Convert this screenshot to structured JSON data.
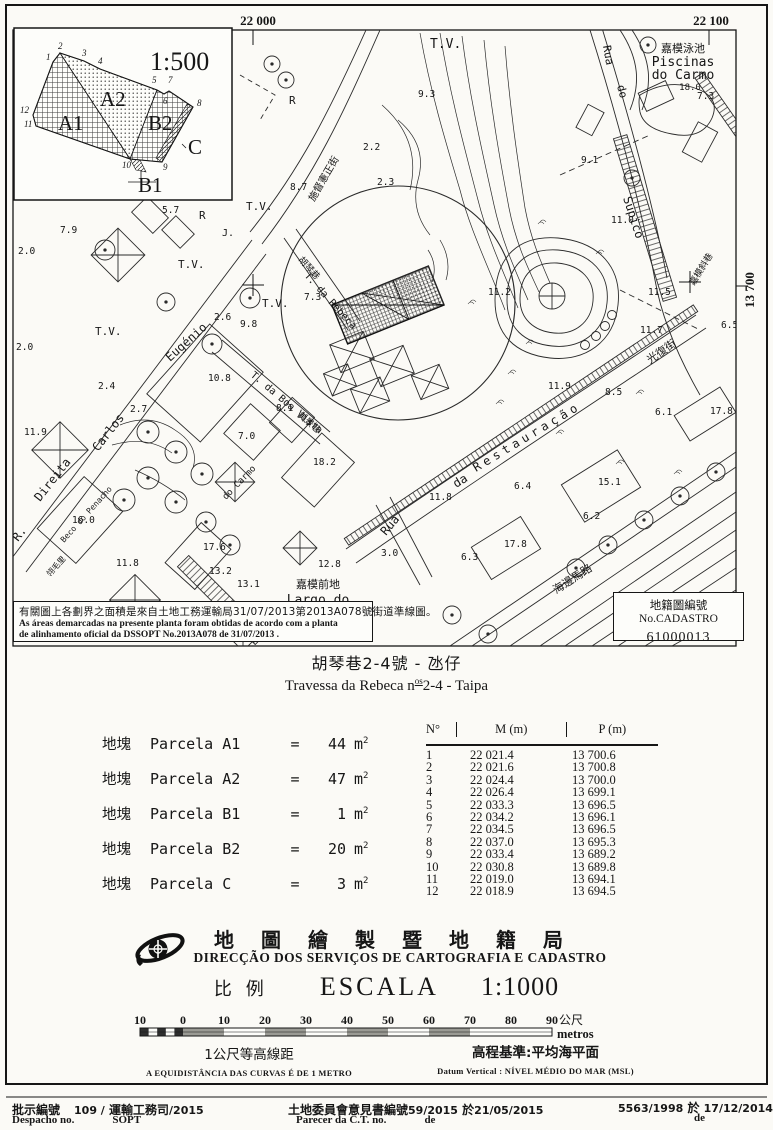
{
  "grid": {
    "top_left": "22 000",
    "top_right": "22 100",
    "right": "13 700"
  },
  "inset": {
    "labels": [
      {
        "t": "1:500",
        "x": 150,
        "y": 70,
        "s": 26,
        "cls": "ser",
        "n": "inset-scale"
      },
      {
        "t": "A1",
        "x": 58,
        "y": 130,
        "s": 21,
        "cls": "ser",
        "n": "parcel-label-a1"
      },
      {
        "t": "A2",
        "x": 100,
        "y": 106,
        "s": 21,
        "cls": "ser",
        "n": "parcel-label-a2"
      },
      {
        "t": "B2",
        "x": 148,
        "y": 130,
        "s": 21,
        "cls": "ser",
        "n": "parcel-label-b2"
      },
      {
        "t": "B1",
        "x": 138,
        "y": 192,
        "s": 21,
        "cls": "ser",
        "n": "parcel-label-b1"
      },
      {
        "t": "C",
        "x": 188,
        "y": 154,
        "s": 21,
        "cls": "ser",
        "n": "parcel-label-c"
      },
      {
        "t": "1",
        "x": 46,
        "y": 60,
        "cls": "vtx"
      },
      {
        "t": "2",
        "x": 58,
        "y": 49,
        "cls": "vtx"
      },
      {
        "t": "3",
        "x": 82,
        "y": 56,
        "cls": "vtx"
      },
      {
        "t": "4",
        "x": 98,
        "y": 64,
        "cls": "vtx"
      },
      {
        "t": "5",
        "x": 152,
        "y": 83,
        "cls": "vtx"
      },
      {
        "t": "7",
        "x": 168,
        "y": 83,
        "cls": "vtx"
      },
      {
        "t": "6",
        "x": 163,
        "y": 104,
        "cls": "vtx"
      },
      {
        "t": "8",
        "x": 197,
        "y": 106,
        "cls": "vtx"
      },
      {
        "t": "12",
        "x": 20,
        "y": 113,
        "cls": "vtx"
      },
      {
        "t": "11",
        "x": 24,
        "y": 127,
        "cls": "vtx"
      },
      {
        "t": "10",
        "x": 122,
        "y": 168,
        "cls": "vtx"
      },
      {
        "t": "9",
        "x": 163,
        "y": 170,
        "cls": "vtx"
      }
    ]
  },
  "map": {
    "labels": [
      {
        "t": "T.V.",
        "x": 430,
        "y": 48,
        "s": 13,
        "cls": "mono"
      },
      {
        "t": "T.V.",
        "x": 246,
        "y": 210,
        "s": 11,
        "cls": "mono"
      },
      {
        "t": "T.V.",
        "x": 178,
        "y": 268,
        "s": 11,
        "cls": "mono"
      },
      {
        "t": "T.V.",
        "x": 262,
        "y": 307,
        "s": 11,
        "cls": "mono"
      },
      {
        "t": "T.V.",
        "x": 95,
        "y": 335,
        "s": 11,
        "cls": "mono"
      },
      {
        "t": "R",
        "x": 289,
        "y": 104,
        "s": 11,
        "cls": "mono"
      },
      {
        "t": "R",
        "x": 199,
        "y": 219,
        "s": 11,
        "cls": "mono"
      },
      {
        "t": "J.",
        "x": 222,
        "y": 236,
        "s": 10,
        "cls": "mono"
      },
      {
        "t": "嘉模泳池",
        "x": 683,
        "y": 52,
        "s": 11,
        "cls": "cjk",
        "anchor": "middle"
      },
      {
        "t": "Piscinas",
        "x": 683,
        "y": 66,
        "s": 13,
        "cls": "mono",
        "anchor": "middle"
      },
      {
        "t": "do Carmo",
        "x": 683,
        "y": 79,
        "s": 13,
        "cls": "mono",
        "anchor": "middle"
      },
      {
        "t": "18.0",
        "x": 690,
        "y": 90,
        "s": 9,
        "cls": "mono",
        "anchor": "middle"
      },
      {
        "t": "Rua",
        "x": 603,
        "y": 46,
        "s": 11,
        "cls": "mono",
        "rot": 80
      },
      {
        "t": "do",
        "x": 617,
        "y": 86,
        "s": 11,
        "cls": "mono",
        "rot": 75
      },
      {
        "t": "Supico",
        "x": 623,
        "y": 198,
        "s": 12,
        "cls": "mono",
        "rot": 72
      },
      {
        "t": "施督憲正街",
        "x": 314,
        "y": 202,
        "s": 10,
        "cls": "cjk",
        "rot": -60
      },
      {
        "t": "胡琴巷",
        "x": 298,
        "y": 260,
        "s": 9,
        "cls": "cjk",
        "rot": 48
      },
      {
        "t": "T. da Rebeca",
        "x": 304,
        "y": 276,
        "s": 10,
        "cls": "mono",
        "rot": 48
      },
      {
        "t": "T. da Boa Vista",
        "x": 250,
        "y": 376,
        "s": 10,
        "cls": "mono",
        "rot": 40
      },
      {
        "t": "美景巷",
        "x": 297,
        "y": 416,
        "s": 9,
        "cls": "cjk",
        "rot": 40
      },
      {
        "t": "Eugénio",
        "x": 170,
        "y": 362,
        "s": 12,
        "cls": "mono",
        "rot": -42
      },
      {
        "t": "Carlos",
        "x": 98,
        "y": 452,
        "s": 12,
        "cls": "mono",
        "rot": -52
      },
      {
        "t": "Direita",
        "x": 40,
        "y": 502,
        "s": 12,
        "cls": "mono",
        "rot": -52
      },
      {
        "t": "R.",
        "x": 18,
        "y": 542,
        "s": 12,
        "cls": "mono",
        "rot": -52
      },
      {
        "t": "Beco do Penacho",
        "x": 64,
        "y": 543,
        "s": 8,
        "cls": "mono",
        "rot": -48
      },
      {
        "t": "翎毛里",
        "x": 50,
        "y": 577,
        "s": 8,
        "cls": "cjk",
        "rot": -48
      },
      {
        "t": "do Carmo",
        "x": 226,
        "y": 500,
        "s": 9,
        "cls": "mono",
        "rot": -46
      },
      {
        "t": "嘉模前地",
        "x": 318,
        "y": 588,
        "s": 11,
        "cls": "cjk",
        "anchor": "middle"
      },
      {
        "t": "Largo do",
        "x": 318,
        "y": 604,
        "s": 13,
        "cls": "mono",
        "anchor": "middle"
      },
      {
        "t": "Carmo",
        "x": 318,
        "y": 619,
        "s": 13,
        "cls": "mono",
        "anchor": "middle"
      },
      {
        "t": "Rua",
        "x": 386,
        "y": 536,
        "s": 12,
        "cls": "mono",
        "rot": -50
      },
      {
        "t": "da",
        "x": 456,
        "y": 488,
        "s": 12,
        "cls": "mono",
        "rot": -31
      },
      {
        "t": "Restauração",
        "x": 476,
        "y": 472,
        "s": 12,
        "cls": "mono",
        "rot": -31,
        "ls": 4
      },
      {
        "t": "光復街",
        "x": 650,
        "y": 364,
        "s": 11,
        "cls": "cjk",
        "rot": -35
      },
      {
        "t": "海邊馬路",
        "x": 556,
        "y": 594,
        "s": 11,
        "cls": "cjk",
        "rot": -33
      },
      {
        "t": "嘉模斜巷",
        "x": 694,
        "y": 286,
        "s": 9,
        "cls": "cjk",
        "rot": -58
      }
    ],
    "spots": [
      {
        "t": "9.3",
        "x": 418,
        "y": 97
      },
      {
        "t": "7.3",
        "x": 697,
        "y": 99
      },
      {
        "t": "7.9",
        "x": 60,
        "y": 233
      },
      {
        "t": "5.7",
        "x": 162,
        "y": 213
      },
      {
        "t": "2.2",
        "x": 363,
        "y": 150
      },
      {
        "t": "2.3",
        "x": 377,
        "y": 185
      },
      {
        "t": "8.7",
        "x": 290,
        "y": 190
      },
      {
        "t": "7.3",
        "x": 304,
        "y": 300
      },
      {
        "t": "9.8",
        "x": 240,
        "y": 327
      },
      {
        "t": "2.0",
        "x": 18,
        "y": 254
      },
      {
        "t": "2.0",
        "x": 16,
        "y": 350
      },
      {
        "t": "2.4",
        "x": 98,
        "y": 389
      },
      {
        "t": "2.6",
        "x": 214,
        "y": 320
      },
      {
        "t": "10.8",
        "x": 208,
        "y": 381
      },
      {
        "t": "2.7",
        "x": 130,
        "y": 412
      },
      {
        "t": "11.9",
        "x": 24,
        "y": 435
      },
      {
        "t": "16.0",
        "x": 72,
        "y": 523
      },
      {
        "t": "7.0",
        "x": 238,
        "y": 439
      },
      {
        "t": "8.1",
        "x": 276,
        "y": 411
      },
      {
        "t": "18.2",
        "x": 313,
        "y": 465
      },
      {
        "t": "17.6",
        "x": 203,
        "y": 550
      },
      {
        "t": "13.2",
        "x": 209,
        "y": 574
      },
      {
        "t": "13.1",
        "x": 237,
        "y": 587
      },
      {
        "t": "11.8",
        "x": 116,
        "y": 566
      },
      {
        "t": "12.8",
        "x": 318,
        "y": 567
      },
      {
        "t": "3.0",
        "x": 381,
        "y": 556
      },
      {
        "t": "9.1",
        "x": 581,
        "y": 163
      },
      {
        "t": "11.0",
        "x": 611,
        "y": 223
      },
      {
        "t": "11.5",
        "x": 648,
        "y": 295
      },
      {
        "t": "11.7",
        "x": 640,
        "y": 333
      },
      {
        "t": "6.5",
        "x": 721,
        "y": 328
      },
      {
        "t": "11.9",
        "x": 548,
        "y": 389
      },
      {
        "t": "8.5",
        "x": 605,
        "y": 395
      },
      {
        "t": "11.2",
        "x": 488,
        "y": 295
      },
      {
        "t": "17.8",
        "x": 710,
        "y": 414
      },
      {
        "t": "6.1",
        "x": 655,
        "y": 415
      },
      {
        "t": "15.1",
        "x": 598,
        "y": 485
      },
      {
        "t": "6.4",
        "x": 514,
        "y": 489
      },
      {
        "t": "6.2",
        "x": 583,
        "y": 519
      },
      {
        "t": "17.8",
        "x": 504,
        "y": 547
      },
      {
        "t": "6.3",
        "x": 461,
        "y": 560
      },
      {
        "t": "11.8",
        "x": 429,
        "y": 500
      }
    ]
  },
  "note_box": {
    "zh": "有關圖上各劃界之面積是來自土地工務運輸局31/07/2013第2013A078號街道準線圖。",
    "pt1": "As áreas demarcadas na presente planta foram obtidas de acordo com a planta",
    "pt2": "de alinhamento oficial da DSSOPT  No.2013A078 de 31/07/2013 ."
  },
  "cadastro_box": {
    "title": "地籍圖編號 No.CADASTRO",
    "number": "61000013"
  },
  "title": {
    "zh": "胡琴巷2-4號 - 氹仔",
    "pt_prefix": "Travessa da Rebeca n",
    "pt_sup": "os",
    "pt_suffix": "2-4 - Taipa"
  },
  "parcels": {
    "label_zh": "地塊",
    "label_pt": "Parcela",
    "equals": "=",
    "unit": "m",
    "unit_sup": "2",
    "rows": [
      {
        "name": "A1",
        "area": "44"
      },
      {
        "name": "A2",
        "area": "47"
      },
      {
        "name": "B1",
        "area": " 1"
      },
      {
        "name": "B2",
        "area": "20"
      },
      {
        "name": "C",
        "area": " 3"
      }
    ]
  },
  "coords": {
    "headers": {
      "n": "N°",
      "m": "M (m)",
      "p": "P (m)"
    },
    "rows": [
      {
        "n": "1",
        "m": "22 021.4",
        "p": "13 700.6"
      },
      {
        "n": "2",
        "m": "22 021.6",
        "p": "13 700.8"
      },
      {
        "n": "3",
        "m": "22 024.4",
        "p": "13 700.0"
      },
      {
        "n": "4",
        "m": "22 026.4",
        "p": "13 699.1"
      },
      {
        "n": "5",
        "m": "22 033.3",
        "p": "13 696.5"
      },
      {
        "n": "6",
        "m": "22 034.2",
        "p": "13 696.1"
      },
      {
        "n": "7",
        "m": "22 034.5",
        "p": "13 696.5"
      },
      {
        "n": "8",
        "m": "22 037.0",
        "p": "13 695.3"
      },
      {
        "n": "9",
        "m": "22 033.4",
        "p": "13 689.2"
      },
      {
        "n": "10",
        "m": "22 030.8",
        "p": "13 689.8"
      },
      {
        "n": "11",
        "m": "22 019.0",
        "p": "13 694.1"
      },
      {
        "n": "12",
        "m": "22 018.9",
        "p": "13 694.5"
      }
    ]
  },
  "agency": {
    "zh": "地圖繪製暨地籍局",
    "pt": "DIRECÇÃO DOS SERVIÇOS DE CARTOGRAFIA E CADASTRO",
    "scale_zh": "比例",
    "scale_pt": "ESCALA",
    "scale_value": "1:1000"
  },
  "scalebar": {
    "ticks": [
      "10",
      "0",
      "10",
      "20",
      "30",
      "40",
      "50",
      "60",
      "70",
      "80",
      "90"
    ],
    "unit_zh": "公尺",
    "unit_pt": "metros"
  },
  "notes": {
    "contour_zh": "1公尺等高線距",
    "contour_pt": "A EQUIDISTÂNCIA DAS CURVAS É DE 1 METRO",
    "datum_zh": "高程基準:平均海平面",
    "datum_pt": "Datum Vertical : NÍVEL MÉDIO DO MAR (MSL)"
  },
  "footer": {
    "despacho_zh": "批示編號",
    "despacho_no": "109 /",
    "despacho_dept_zh": "運輸工務司",
    "despacho_year": "/2015",
    "despacho_pt": "Despacho no.",
    "despacho_dept_pt": "SOPT",
    "parecer_zh": "土地委員會意見書編號",
    "parecer_no": "59/2015",
    "parecer_at": "於",
    "parecer_date": "21/05/2015",
    "parecer_pt": "Parecer da C.T. no.",
    "parecer_de": "de",
    "ref_no": "5563/1998",
    "ref_at": "於",
    "ref_date": "17/12/2014",
    "ref_de": "de"
  }
}
